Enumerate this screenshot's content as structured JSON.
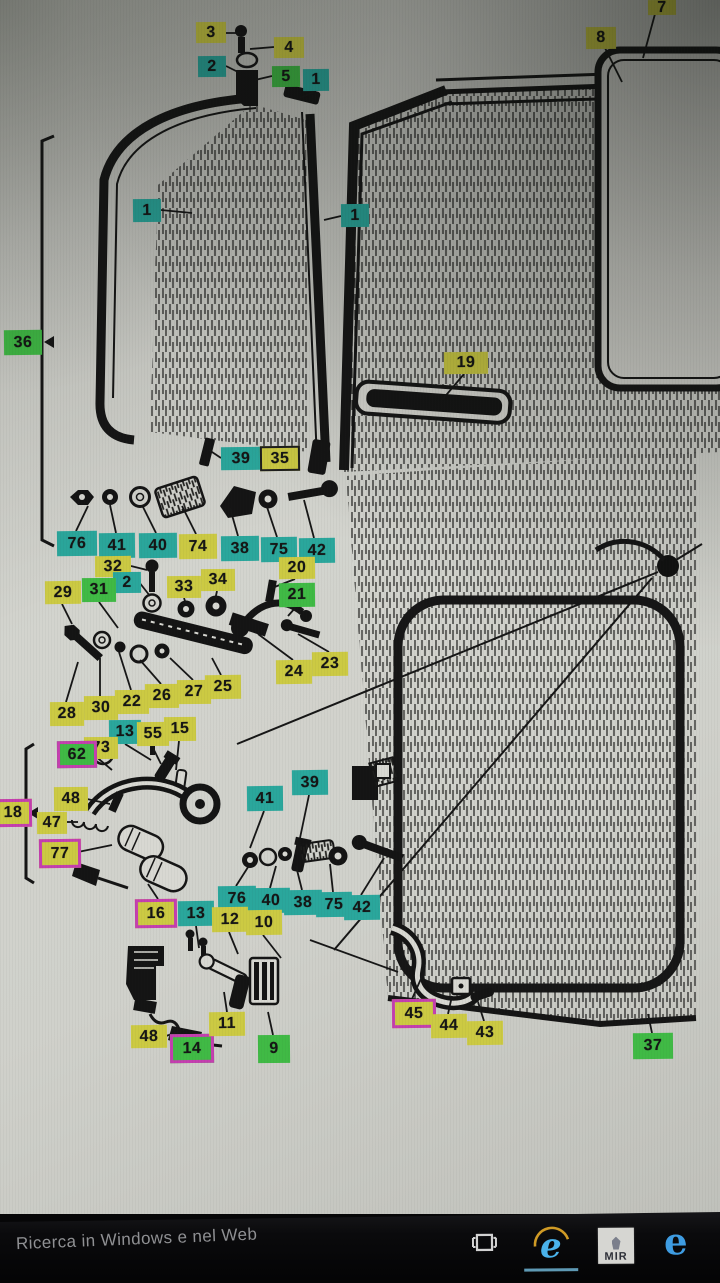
{
  "screen": {
    "description": "Photo of a monitor showing an exploded parts diagram of a vehicle door (vent window, hinges, window regulator, lock mechanism) with highlighted part numbers"
  },
  "diagram": {
    "highlight_colors": {
      "yellow": "#ccca43",
      "teal": "#2aa79c",
      "green": "#40ba45",
      "pink_border": "#c53fb0",
      "black_border": "#1d1d1d"
    },
    "labels": [
      {
        "text": "3",
        "color": "yellow",
        "x": 196,
        "y": 22,
        "w": 30,
        "h": 21
      },
      {
        "text": "4",
        "color": "yellow",
        "x": 274,
        "y": 37,
        "w": 30,
        "h": 21
      },
      {
        "text": "2",
        "color": "teal",
        "x": 198,
        "y": 56,
        "w": 28,
        "h": 21
      },
      {
        "text": "5",
        "color": "green",
        "x": 272,
        "y": 66,
        "w": 28,
        "h": 21
      },
      {
        "text": "1",
        "color": "teal",
        "x": 303,
        "y": 69,
        "w": 26,
        "h": 22
      },
      {
        "text": "7",
        "color": "yellow",
        "x": 648,
        "y": 0,
        "w": 28,
        "h": 15
      },
      {
        "text": "8",
        "color": "yellow",
        "x": 586,
        "y": 27,
        "w": 30,
        "h": 22
      },
      {
        "text": "1",
        "color": "teal",
        "x": 133,
        "y": 199,
        "w": 28,
        "h": 23
      },
      {
        "text": "1",
        "color": "teal",
        "x": 341,
        "y": 204,
        "w": 28,
        "h": 23
      },
      {
        "text": "36",
        "color": "green",
        "x": 4,
        "y": 330,
        "w": 38,
        "h": 25
      },
      {
        "text": "19",
        "color": "yellow",
        "x": 444,
        "y": 352,
        "w": 44,
        "h": 22
      },
      {
        "text": "39",
        "color": "teal",
        "x": 221,
        "y": 447,
        "w": 40,
        "h": 23
      },
      {
        "text": "35",
        "color": "yellow",
        "x": 260,
        "y": 446,
        "w": 40,
        "h": 25,
        "border": "black"
      },
      {
        "text": "76",
        "color": "teal",
        "x": 57,
        "y": 531,
        "w": 40,
        "h": 25
      },
      {
        "text": "41",
        "color": "teal",
        "x": 99,
        "y": 533,
        "w": 36,
        "h": 25
      },
      {
        "text": "40",
        "color": "teal",
        "x": 139,
        "y": 533,
        "w": 38,
        "h": 25
      },
      {
        "text": "74",
        "color": "yellow",
        "x": 179,
        "y": 534,
        "w": 38,
        "h": 25
      },
      {
        "text": "38",
        "color": "teal",
        "x": 221,
        "y": 536,
        "w": 38,
        "h": 25
      },
      {
        "text": "75",
        "color": "teal",
        "x": 261,
        "y": 537,
        "w": 36,
        "h": 25
      },
      {
        "text": "42",
        "color": "teal",
        "x": 299,
        "y": 538,
        "w": 36,
        "h": 25
      },
      {
        "text": "32",
        "color": "yellow",
        "x": 95,
        "y": 556,
        "w": 36,
        "h": 21
      },
      {
        "text": "2",
        "color": "teal",
        "x": 113,
        "y": 572,
        "w": 28,
        "h": 21
      },
      {
        "text": "33",
        "color": "yellow",
        "x": 167,
        "y": 576,
        "w": 34,
        "h": 22
      },
      {
        "text": "34",
        "color": "yellow",
        "x": 201,
        "y": 569,
        "w": 34,
        "h": 22
      },
      {
        "text": "20",
        "color": "yellow",
        "x": 279,
        "y": 557,
        "w": 36,
        "h": 22
      },
      {
        "text": "29",
        "color": "yellow",
        "x": 45,
        "y": 581,
        "w": 36,
        "h": 23
      },
      {
        "text": "31",
        "color": "green",
        "x": 82,
        "y": 578,
        "w": 34,
        "h": 24
      },
      {
        "text": "21",
        "color": "green",
        "x": 279,
        "y": 583,
        "w": 36,
        "h": 24
      },
      {
        "text": "23",
        "color": "yellow",
        "x": 312,
        "y": 652,
        "w": 36,
        "h": 24
      },
      {
        "text": "24",
        "color": "yellow",
        "x": 276,
        "y": 660,
        "w": 36,
        "h": 24
      },
      {
        "text": "25",
        "color": "yellow",
        "x": 205,
        "y": 675,
        "w": 36,
        "h": 24
      },
      {
        "text": "27",
        "color": "yellow",
        "x": 177,
        "y": 680,
        "w": 34,
        "h": 24
      },
      {
        "text": "26",
        "color": "yellow",
        "x": 145,
        "y": 684,
        "w": 34,
        "h": 24
      },
      {
        "text": "22",
        "color": "yellow",
        "x": 115,
        "y": 690,
        "w": 34,
        "h": 24
      },
      {
        "text": "30",
        "color": "yellow",
        "x": 84,
        "y": 696,
        "w": 34,
        "h": 24
      },
      {
        "text": "28",
        "color": "yellow",
        "x": 50,
        "y": 702,
        "w": 34,
        "h": 24
      },
      {
        "text": "13",
        "color": "teal",
        "x": 109,
        "y": 720,
        "w": 32,
        "h": 24
      },
      {
        "text": "55",
        "color": "yellow",
        "x": 137,
        "y": 722,
        "w": 32,
        "h": 24
      },
      {
        "text": "15",
        "color": "yellow",
        "x": 164,
        "y": 717,
        "w": 32,
        "h": 24
      },
      {
        "text": "73",
        "color": "yellow",
        "x": 84,
        "y": 737,
        "w": 34,
        "h": 22
      },
      {
        "text": "62",
        "color": "green",
        "x": 57,
        "y": 741,
        "w": 40,
        "h": 27,
        "border": "pink"
      },
      {
        "text": "48",
        "color": "yellow",
        "x": 54,
        "y": 787,
        "w": 34,
        "h": 24
      },
      {
        "text": "47",
        "color": "yellow",
        "x": 37,
        "y": 812,
        "w": 30,
        "h": 22
      },
      {
        "text": "77",
        "color": "yellow",
        "x": 39,
        "y": 839,
        "w": 42,
        "h": 29,
        "border": "pink"
      },
      {
        "text": "18",
        "color": "yellow",
        "x": -6,
        "y": 799,
        "w": 38,
        "h": 28,
        "border": "pink"
      },
      {
        "text": "41",
        "color": "teal",
        "x": 247,
        "y": 786,
        "w": 36,
        "h": 25
      },
      {
        "text": "39",
        "color": "teal",
        "x": 292,
        "y": 770,
        "w": 36,
        "h": 25
      },
      {
        "text": "76",
        "color": "teal",
        "x": 218,
        "y": 886,
        "w": 38,
        "h": 25
      },
      {
        "text": "40",
        "color": "teal",
        "x": 252,
        "y": 888,
        "w": 38,
        "h": 25
      },
      {
        "text": "38",
        "color": "teal",
        "x": 284,
        "y": 890,
        "w": 38,
        "h": 25
      },
      {
        "text": "75",
        "color": "teal",
        "x": 316,
        "y": 892,
        "w": 36,
        "h": 25
      },
      {
        "text": "42",
        "color": "teal",
        "x": 344,
        "y": 895,
        "w": 36,
        "h": 25
      },
      {
        "text": "16",
        "color": "yellow",
        "x": 135,
        "y": 899,
        "w": 42,
        "h": 29,
        "border": "pink"
      },
      {
        "text": "13",
        "color": "teal",
        "x": 178,
        "y": 901,
        "w": 36,
        "h": 25
      },
      {
        "text": "12",
        "color": "yellow",
        "x": 212,
        "y": 907,
        "w": 36,
        "h": 25
      },
      {
        "text": "10",
        "color": "yellow",
        "x": 246,
        "y": 910,
        "w": 36,
        "h": 25
      },
      {
        "text": "48",
        "color": "yellow",
        "x": 131,
        "y": 1025,
        "w": 36,
        "h": 23
      },
      {
        "text": "14",
        "color": "green",
        "x": 170,
        "y": 1034,
        "w": 44,
        "h": 29,
        "border": "pink"
      },
      {
        "text": "11",
        "color": "yellow",
        "x": 209,
        "y": 1012,
        "w": 36,
        "h": 24
      },
      {
        "text": "9",
        "color": "green",
        "x": 258,
        "y": 1035,
        "w": 32,
        "h": 28
      },
      {
        "text": "45",
        "color": "yellow",
        "x": 392,
        "y": 999,
        "w": 44,
        "h": 29,
        "border": "pink"
      },
      {
        "text": "44",
        "color": "yellow",
        "x": 431,
        "y": 1014,
        "w": 36,
        "h": 24
      },
      {
        "text": "43",
        "color": "yellow",
        "x": 467,
        "y": 1021,
        "w": 36,
        "h": 24
      },
      {
        "text": "37",
        "color": "green",
        "x": 633,
        "y": 1033,
        "w": 40,
        "h": 26
      }
    ]
  },
  "taskbar": {
    "search_text": "Ricerca in Windows e nel Web",
    "icons": [
      {
        "name": "task-view"
      },
      {
        "name": "internet-explorer",
        "active": true
      },
      {
        "name": "mir",
        "label": "MIR"
      },
      {
        "name": "edge"
      }
    ]
  }
}
